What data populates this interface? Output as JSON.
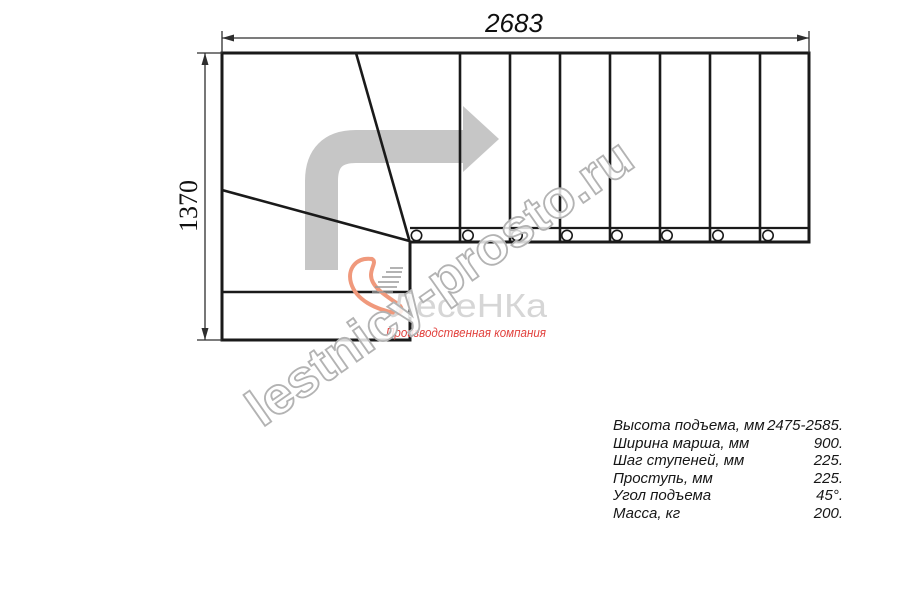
{
  "dimensions": {
    "width_label": "2683",
    "height_label": "1370"
  },
  "watermark": {
    "text": "lestnicy-prosto.ru"
  },
  "logo": {
    "brand": "ЛесеНКа",
    "tagline": "Производственная компания"
  },
  "specs": {
    "rows": [
      {
        "label": "Высота подъема, мм",
        "value": "2475-2585."
      },
      {
        "label": "Ширина марша, мм",
        "value": "900."
      },
      {
        "label": "Шаг ступеней, мм",
        "value": "225."
      },
      {
        "label": "Проступь, мм",
        "value": "225."
      },
      {
        "label": "Угол подъема",
        "value": "45°."
      },
      {
        "label": "Масса, кг",
        "value": "200."
      }
    ]
  },
  "colors": {
    "line": "#1a1a1a",
    "arrow": "#c6c6c6",
    "logo_accent": "#f0997c",
    "logo_text": "#d6d6d6",
    "tagline": "#e2423e",
    "watermark": "#b3b3b3"
  }
}
